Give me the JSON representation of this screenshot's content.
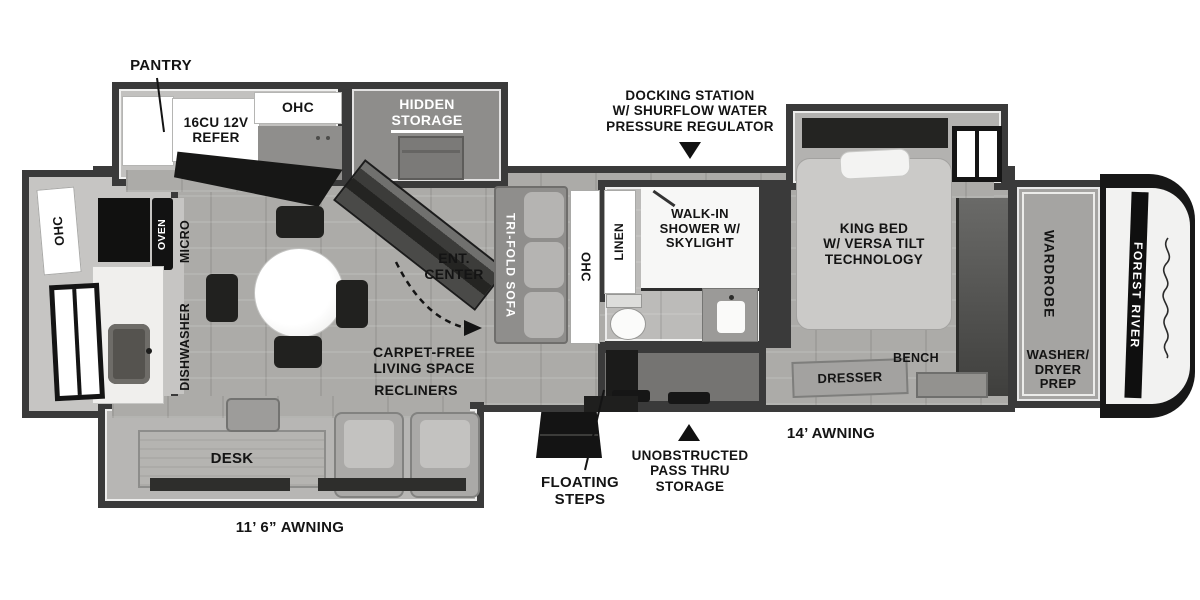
{
  "brand": {
    "name": "FOREST RIVER"
  },
  "callouts": {
    "pantry": "PANTRY",
    "docking_station": "DOCKING STATION\nW/ SHURFLOW WATER\nPRESSURE REGULATOR",
    "floating_steps": "FLOATING\nSTEPS",
    "pass_thru": "UNOBSTRUCTED\nPASS THRU\nSTORAGE",
    "awning_rear": "11’ 6” AWNING",
    "awning_front": "14’ AWNING"
  },
  "kitchen": {
    "refer": "16CU 12V\nREFER",
    "ohc_top": "OHC",
    "hidden_storage": "HIDDEN\nSTORAGE",
    "ohc_rear": "OHC",
    "oven": "OVEN",
    "micro": "MICRO",
    "dishwasher": "DISHWASHER"
  },
  "living": {
    "ent_center": "ENT.\nCENTER",
    "sofa": "TRI-FOLD SOFA",
    "ohc": "OHC",
    "carpet_free": "CARPET-FREE\nLIVING SPACE",
    "recliners": "RECLINERS",
    "desk": "DESK"
  },
  "bath": {
    "linen": "LINEN",
    "shower": "WALK-IN\nSHOWER W/\nSKYLIGHT"
  },
  "bedroom": {
    "king_bed": "KING BED\nW/ VERSA TILT\nTECHNOLOGY",
    "dresser": "DRESSER",
    "bench": "BENCH"
  },
  "front": {
    "wardrobe": "WARDROBE",
    "washer_dryer": "WASHER/\nDRYER\nPREP"
  },
  "colors": {
    "wall": "#3a3a3a",
    "floor": "#acaba8",
    "ink": "#141414",
    "white": "#ffffff"
  }
}
